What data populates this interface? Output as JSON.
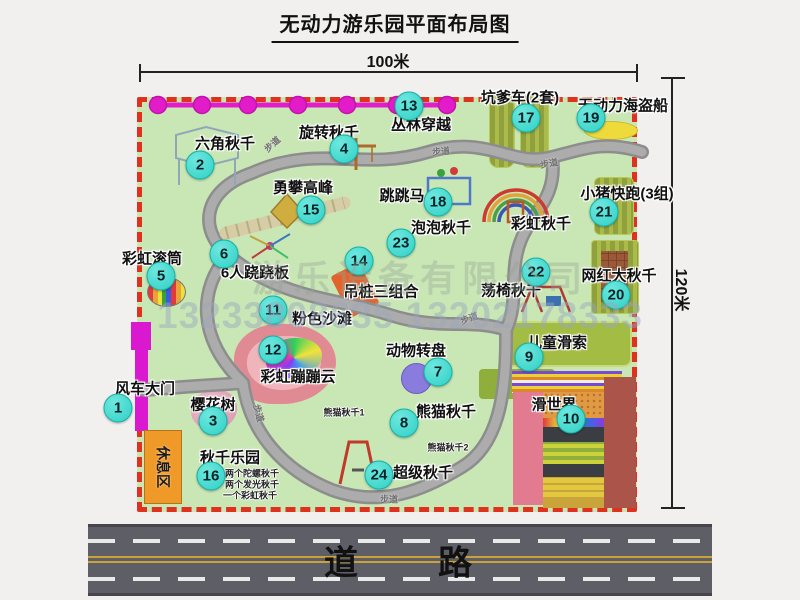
{
  "title": "无动力游乐园平面布局图",
  "dimensions": {
    "width_label": "100米",
    "height_label": "120米"
  },
  "watermark": {
    "company": "游乐设备有限公司",
    "phones": "13233808635 13202178333"
  },
  "road": {
    "label": "道　　路"
  },
  "rest_area": {
    "label": "休息区"
  },
  "path_label": "步道",
  "colors": {
    "map_bg": "#c9e7b5",
    "border": "#e0301e",
    "badge": "#2fd0c6",
    "zipline": "#e21cc8",
    "road": "#5d5e66"
  },
  "walkways": [
    {
      "x": 272,
      "y": 144,
      "rot": -42
    },
    {
      "x": 441,
      "y": 151,
      "rot": -5
    },
    {
      "x": 549,
      "y": 163,
      "rot": -10
    },
    {
      "x": 469,
      "y": 318,
      "rot": -20
    },
    {
      "x": 259,
      "y": 413,
      "rot": 75
    },
    {
      "x": 389,
      "y": 499,
      "rot": 0
    }
  ],
  "attractions": [
    {
      "num": "1",
      "label": "风车大门",
      "lx": 145,
      "ly": 388,
      "bx": 118,
      "by": 408
    },
    {
      "num": "2",
      "label": "六角秋千",
      "lx": 225,
      "ly": 143,
      "bx": 200,
      "by": 165
    },
    {
      "num": "3",
      "label": "樱花树",
      "lx": 213,
      "ly": 404,
      "bx": 213,
      "by": 421
    },
    {
      "num": "4",
      "label": "旋转秋千",
      "lx": 329,
      "ly": 132,
      "bx": 344,
      "by": 149
    },
    {
      "num": "5",
      "label": "彩虹滚筒",
      "lx": 152,
      "ly": 258,
      "bx": 161,
      "by": 276
    },
    {
      "num": "6",
      "label": "6人跷跷板",
      "lx": 255,
      "ly": 272,
      "bx": 224,
      "by": 254
    },
    {
      "num": "7",
      "label": "动物转盘",
      "lx": 416,
      "ly": 350,
      "bx": 438,
      "by": 372
    },
    {
      "num": "8",
      "label": "熊猫秋千",
      "lx": 446,
      "ly": 411,
      "bx": 404,
      "by": 423
    },
    {
      "num": "9",
      "label": "儿童滑索",
      "lx": 557,
      "ly": 342,
      "bx": 529,
      "by": 357
    },
    {
      "num": "10",
      "label": "滑世界",
      "lx": 554,
      "ly": 404,
      "bx": 571,
      "by": 419
    },
    {
      "num": "11",
      "label": "粉色沙滩",
      "lx": 322,
      "ly": 318,
      "bx": 273,
      "by": 310
    },
    {
      "num": "12",
      "label": "彩虹蹦蹦云",
      "lx": 298,
      "ly": 376,
      "bx": 273,
      "by": 350
    },
    {
      "num": "13",
      "label": "丛林穿越",
      "lx": 421,
      "ly": 124,
      "bx": 409,
      "by": 106
    },
    {
      "num": "14",
      "label": "吊桩三组合",
      "lx": 381,
      "ly": 291,
      "bx": 359,
      "by": 261
    },
    {
      "num": "15",
      "label": "勇攀高峰",
      "lx": 303,
      "ly": 187,
      "bx": 311,
      "by": 210
    },
    {
      "num": "16",
      "label": "秋千乐园",
      "lx": 230,
      "ly": 457,
      "bx": 211,
      "by": 476
    },
    {
      "num": "17",
      "label": "坑爹车(2套)",
      "lx": 520,
      "ly": 97,
      "bx": 526,
      "by": 118
    },
    {
      "num": "18",
      "label": "跳跳马",
      "lx": 402,
      "ly": 195,
      "bx": 438,
      "by": 202
    },
    {
      "num": "19",
      "label": "无动力海盗船",
      "lx": 623,
      "ly": 105,
      "bx": 591,
      "by": 118
    },
    {
      "num": "20",
      "label": "网红大秋千",
      "lx": 619,
      "ly": 275,
      "bx": 616,
      "by": 295
    },
    {
      "num": "21",
      "label": "小猪快跑(3组)",
      "lx": 627,
      "ly": 193,
      "bx": 604,
      "by": 212
    },
    {
      "num": "22",
      "label": "荡椅秋千",
      "lx": 511,
      "ly": 290,
      "bx": 536,
      "by": 272
    },
    {
      "num": "23",
      "label": "泡泡秋千",
      "lx": 441,
      "ly": 227,
      "bx": 401,
      "by": 243
    },
    {
      "num": "24",
      "label": "超级秋千",
      "lx": 423,
      "ly": 472,
      "bx": 379,
      "by": 475
    },
    {
      "num": null,
      "label": "彩虹秋千",
      "lx": 541,
      "ly": 223
    }
  ],
  "notes": [
    {
      "text": "熊猫秋千1",
      "x": 344,
      "y": 412
    },
    {
      "text": "熊猫秋千2",
      "x": 448,
      "y": 447
    },
    {
      "text": "两个陀螺秋千",
      "x": 252,
      "y": 473
    },
    {
      "text": "两个发光秋千",
      "x": 252,
      "y": 484
    },
    {
      "text": "一个彩虹秋千",
      "x": 250,
      "y": 495
    }
  ]
}
